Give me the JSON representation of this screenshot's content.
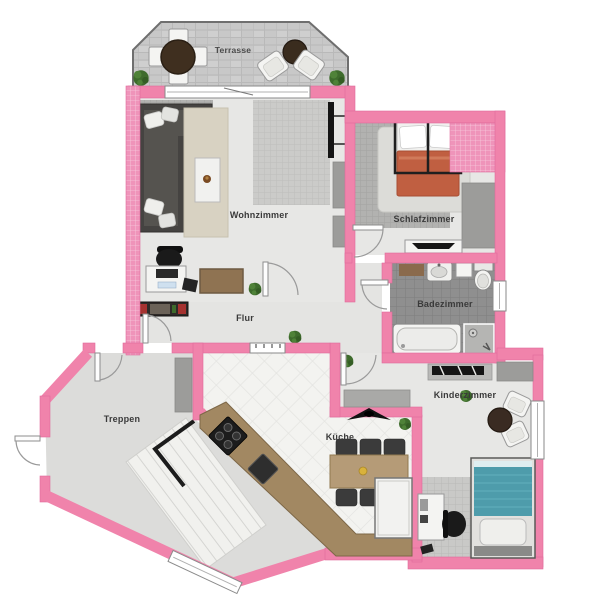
{
  "plan": {
    "type": "apartment-floorplan",
    "rooms": [
      {
        "id": "terrasse",
        "label": "Terrasse"
      },
      {
        "id": "wohnzimmer",
        "label": "Wohnzimmer"
      },
      {
        "id": "schlafzimmer",
        "label": "Schlafzimmer"
      },
      {
        "id": "badezimmer",
        "label": "Badezimmer"
      },
      {
        "id": "flur",
        "label": "Flur"
      },
      {
        "id": "treppen",
        "label": "Treppen"
      },
      {
        "id": "kueche",
        "label": "Küche"
      },
      {
        "id": "kinderzimmer",
        "label": "Kinderzimmer"
      }
    ],
    "colors": {
      "wall_pink": "#f083ab",
      "wall_pink_hatched": "#ef94ba",
      "terrace_stone": "#c8c8c8",
      "floor_light": "#e7e7e5",
      "tile_gray": "#b2b2b0",
      "bath_tile": "#8f8f8f",
      "kitchen_tile": "#f3f3f0",
      "wood_counter": "#a28862",
      "wood_table": "#b59b77",
      "sofa_dark": "#454341",
      "bed_blanket_orange": "#c05f41",
      "kid_bed_teal": "#4e9cab",
      "plant_green": "#3e6b2c",
      "chair_dark": "#3b3b3b"
    },
    "furniture_icons": [
      "terrace-dining-set-icon",
      "lounge-chairs-icon",
      "sofa-icon",
      "area-rug-icon",
      "coffee-table-icon",
      "tv-icon",
      "computer-desk-icon",
      "office-chair-icon",
      "sideboard-icon",
      "double-bed-icon",
      "wardrobe-icon",
      "tv-board-icon",
      "bath-mat-icon",
      "sink-icon",
      "toilet-icon",
      "bathtub-icon",
      "shower-icon",
      "shoe-shelf-icon",
      "stairs-icon",
      "stair-railing-icon",
      "kitchen-counter-icon",
      "stove-icon",
      "cooktop-icon",
      "dining-table-icon",
      "dining-chair-icon",
      "fridge-icon",
      "ceiling-lamp-icon",
      "wall-shelf-icon",
      "armchair-icon",
      "side-table-icon",
      "kids-bed-icon",
      "kids-desk-icon",
      "desk-chair-icon",
      "plant-icon",
      "door-icon",
      "window-icon"
    ]
  }
}
